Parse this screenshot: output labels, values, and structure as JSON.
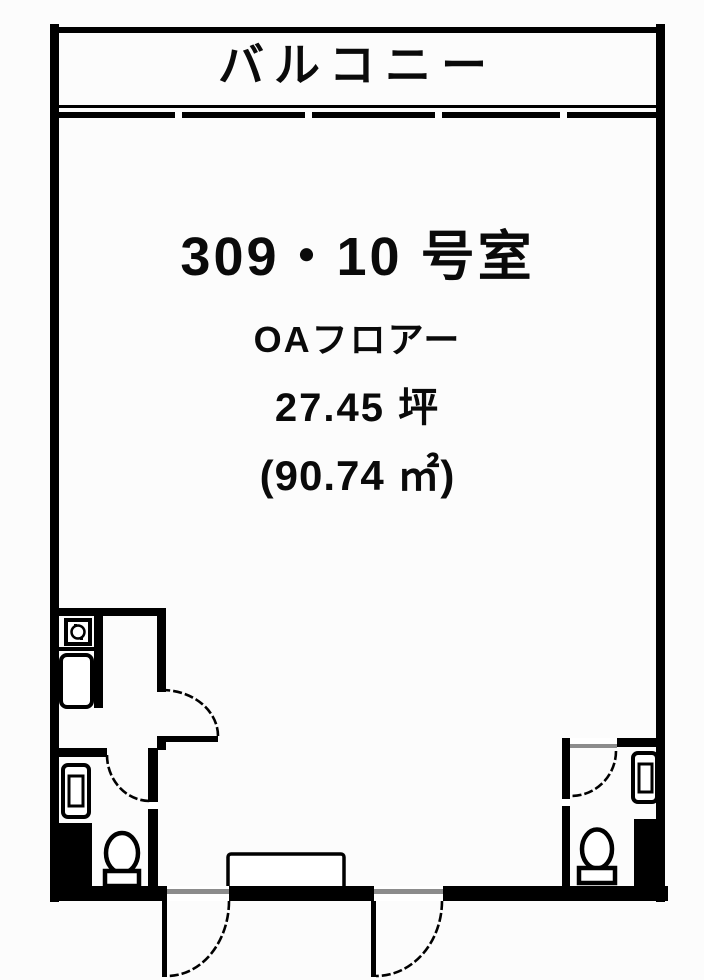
{
  "floorplan": {
    "balcony_label": "バルコニー",
    "room_number": "309・10 号室",
    "floor_spec": "OAフロアー",
    "area_tsubo": "27.45 坪",
    "area_sqm": "(90.74 ㎡)",
    "colors": {
      "line": "#000000",
      "fill": "#ffffff",
      "threshold": "#8c8c8c",
      "background": "#fcfcfc"
    },
    "fixture_icons": [
      "stove-icon",
      "kitchen-sink-icon",
      "wash-basin-icon",
      "toilet-icon",
      "door-swing-arc-icon",
      "entrance-step",
      "balcony-window-line"
    ]
  }
}
